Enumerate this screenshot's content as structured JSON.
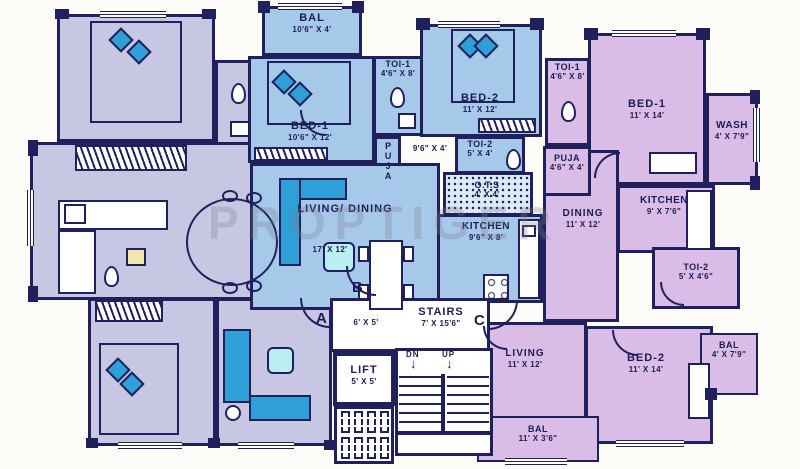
{
  "watermark": "PROPTIGER",
  "colors": {
    "wall": "#20205c",
    "unit_a": "#c7c7e4",
    "unit_b": "#a6c9ea",
    "unit_c": "#dabde6",
    "accent": "#2f9fd7"
  },
  "units": {
    "a": {
      "label": "A"
    },
    "b": {
      "label": "B",
      "rooms": {
        "bal": {
          "name": "BAL",
          "dim": "10'6\" X 4'"
        },
        "bed1": {
          "name": "BED-1",
          "dim": "10'6\" X 12'"
        },
        "toi1": {
          "name": "TOI-1",
          "dim": "4'6\" X 8'"
        },
        "bed2": {
          "name": "BED-2",
          "dim": "11' X 12'"
        },
        "puja": {
          "name": "PUJA"
        },
        "passage": {
          "dim": "9'6\" X 4'"
        },
        "toi2": {
          "name": "TOI-2",
          "dim": "5' X 4'"
        },
        "ots": {
          "name": "O.T.S",
          "dim": "4' X 4'"
        },
        "kitchen": {
          "name": "KITCHEN",
          "dim": "9'6\" X 8'"
        },
        "living_dining": {
          "name": "LIVING/ DINING",
          "dim": "17' X 12'"
        }
      }
    },
    "c": {
      "label": "C",
      "rooms": {
        "bed1": {
          "name": "BED-1",
          "dim": "11' X 14'"
        },
        "toi1": {
          "name": "TOI-1",
          "dim": "4'6\" X 8'"
        },
        "puja": {
          "name": "PUJA",
          "dim": "4'6\" X 4'"
        },
        "wash": {
          "name": "WASH",
          "dim": "4' X 7'9\""
        },
        "kitchen": {
          "name": "KITCHEN",
          "dim": "9' X 7'6\""
        },
        "dining": {
          "name": "DINING",
          "dim": "11' X 12'"
        },
        "toi2": {
          "name": "TOI-2",
          "dim": "5' X 4'6\""
        },
        "living": {
          "name": "LIVING",
          "dim": "11' X 12'"
        },
        "bed2": {
          "name": "BED-2",
          "dim": "11' X 14'"
        },
        "bal_side": {
          "name": "BAL",
          "dim": "4' X 7'9\""
        },
        "bal_bottom": {
          "name": "BAL",
          "dim": "11' X 3'6\""
        }
      }
    }
  },
  "core": {
    "stairs": {
      "name": "STAIRS",
      "dim": "7' X 15'6\""
    },
    "lobby_dim": "6' X 5'",
    "lift": {
      "name": "LIFT",
      "dim": "5' X 5'"
    },
    "dn": "DN",
    "up": "UP"
  }
}
